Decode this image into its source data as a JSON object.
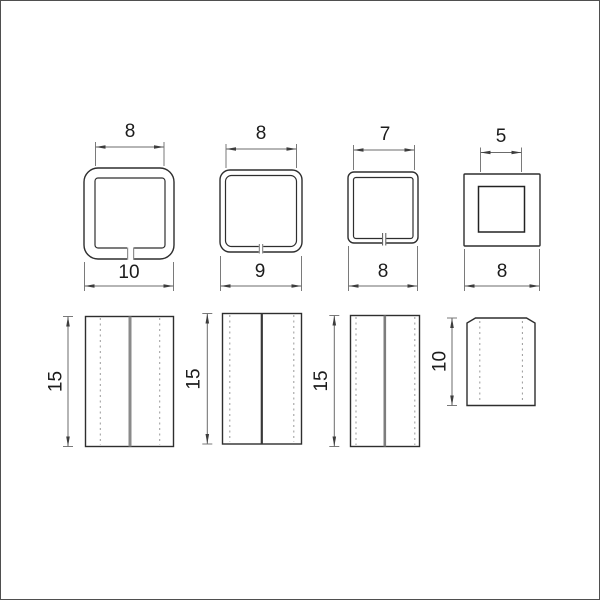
{
  "figure": {
    "kind": "technical dimension drawing",
    "subject": "square tube cap profiles: four cross-sections (top row) and four side views (bottom row)",
    "background_color": "#ffffff",
    "frame_color": "#4f4f4f",
    "outline_color": "#2e2e2e",
    "dimension_line_color": "#6b6b6b",
    "hidden_line_color": "#9a9a9a",
    "text_color": "#1c1c1c"
  },
  "profiles": [
    {
      "inner_width": "8",
      "outer_width": "10",
      "height": "15"
    },
    {
      "inner_width": "8",
      "outer_width": "9",
      "height": "15"
    },
    {
      "inner_width": "7",
      "outer_width": "8",
      "height": "15"
    },
    {
      "inner_width": "5",
      "outer_width": "8",
      "height": "10"
    }
  ]
}
